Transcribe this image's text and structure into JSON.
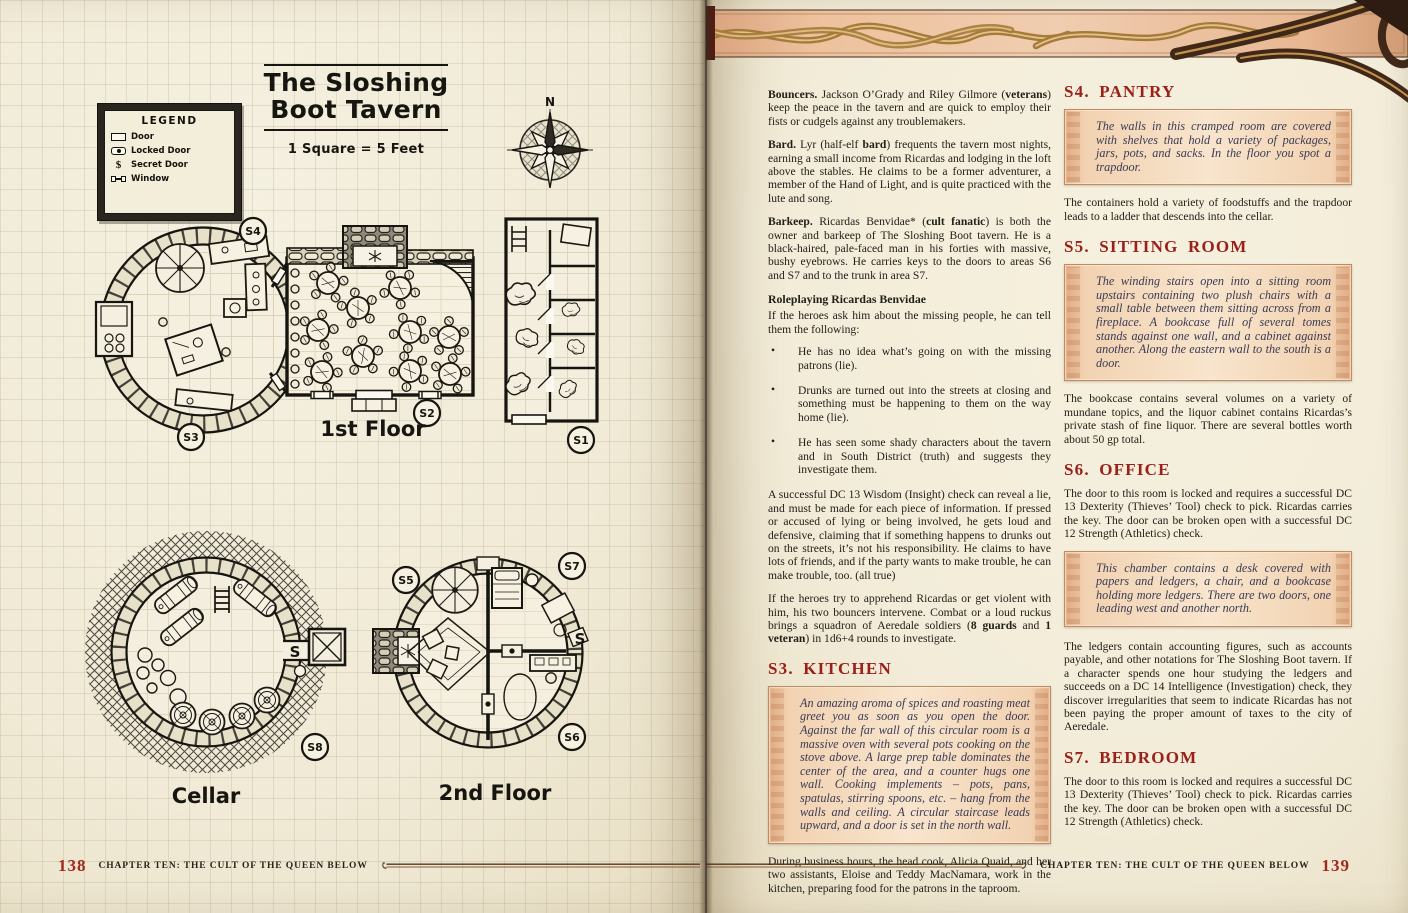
{
  "book": {
    "colors": {
      "heading_red": "#9b2019",
      "page_number_red": "#a02820",
      "parchment": "#f2ecd9",
      "readaloud_peach": "#f2d2b1",
      "band_gold": "#b18443",
      "ink": "#17150f"
    },
    "left_page": {
      "map": {
        "title": "The Sloshing Boot Tavern",
        "scale": "1 Square = 5 Feet",
        "compass_n": "N",
        "legend": {
          "title": "LEGEND",
          "door": "Door",
          "locked_door": "Locked Door",
          "secret_door": "Secret Door",
          "window": "Window",
          "secret_symbol": "$"
        },
        "captions": {
          "first_floor": "1st Floor",
          "cellar": "Cellar",
          "second_floor": "2nd Floor"
        },
        "labels": {
          "s1": "S1",
          "s2": "S2",
          "s3": "S3",
          "s4": "S4",
          "s5": "S5",
          "s6": "S6",
          "s7": "S7",
          "s8": "S8"
        },
        "secret_door_glyph": "S"
      },
      "footer": {
        "page_number": "138",
        "chapter": "CHAPTER TEN: THE CULT OF THE QUEEN BELOW"
      }
    },
    "right_page": {
      "col1": {
        "paragraphs": [
          [
            [
              "b",
              "Bouncers. "
            ],
            [
              "",
              "Jackson O’Grady and Riley Gilmore ("
            ],
            [
              "b",
              "veterans"
            ],
            [
              "",
              ") keep the peace in the tavern and are quick to employ their fists or cudgels against any troublemakers."
            ]
          ],
          [
            [
              "b",
              "Bard. "
            ],
            [
              "",
              "Lyr (half-elf "
            ],
            [
              "b",
              "bard"
            ],
            [
              "",
              ") frequents the tavern most nights, earning a small income from Ricardas and lodging in the loft above the stables. He claims to be a former adventurer, a member of the Hand of Light, and is quite practiced with the lute and song."
            ]
          ],
          [
            [
              "b",
              "Barkeep. "
            ],
            [
              "",
              "Ricardas Benvidae* ("
            ],
            [
              "b",
              "cult fanatic"
            ],
            [
              "",
              ") is both the owner and barkeep of The Sloshing Boot tavern. He is a black-haired, pale-faced man in his forties with massive, bushy eyebrows. He carries keys to the doors to areas S6 and S7 and to the trunk in area S7."
            ]
          ]
        ],
        "roleplaying": {
          "heading": "Roleplaying Ricardas Benvidae",
          "intro": "If the heroes ask him about the missing people, he can tell them the following:",
          "bullets": [
            "He has no idea what’s going on with the missing patrons (lie).",
            "Drunks are turned out into the streets at closing and something must be happening to them on the way home (lie).",
            "He has seen some shady characters about the tavern and in South District (truth) and suggests they investigate them."
          ]
        },
        "insight_paragraph": "A successful DC 13 Wisdom (Insight) check can reveal a lie, and must be made for each piece of information. If pressed or accused of lying or being involved, he gets loud and defensive, claiming that if something happens to drunks out on the streets, it’s not his responsibility. He claims to have lots of friends, and if the party wants to make trouble, he can make trouble, too. (all true)",
        "apprehend_paragraph": [
          [
            "",
            "If the heroes try to apprehend Ricardas or get violent with him, his two bouncers intervene. Combat or a loud ruckus brings a squadron of Aeredale soldiers ("
          ],
          [
            "b",
            "8 guards"
          ],
          [
            "",
            " and "
          ],
          [
            "b",
            "1 veteran"
          ],
          [
            "",
            ") in 1d6+4 rounds to investigate."
          ]
        ],
        "s3": {
          "heading": "S3. KITCHEN",
          "box": "An amazing aroma of spices and roasting meat greet you as soon as you open the door. Against the far wall of this circular room is a massive oven with several pots cooking on the stove above. A large prep table dominates the center of the area, and a counter hugs one wall. Cooking implements – pots, pans, spatulas, stirring spoons, etc. – hang from the walls and ceiling. A circular staircase leads upward, and a door is set in the north wall.",
          "after": "During business hours, the head cook, Alicia Quaid, and her two assistants, Eloise and Teddy MacNamara, work in the kitchen, preparing food for the patrons in the taproom."
        }
      },
      "col2": {
        "s4": {
          "heading": "S4. PANTRY",
          "box": "The walls in this cramped room are covered with shelves that hold a variety of packages, jars, pots, and sacks. In the floor you spot a trapdoor.",
          "after": "The containers hold a variety of foodstuffs and the trapdoor leads to a ladder that descends into the cellar."
        },
        "s5": {
          "heading": "S5. SITTING ROOM",
          "box": "The winding stairs open into a sitting room upstairs containing two plush chairs with a small table between them sitting across from a fireplace. A bookcase full of several tomes stands against one wall, and a cabinet against another. Along the eastern wall to the south is a door.",
          "after": "The bookcase contains several volumes on a variety of mundane topics, and the liquor cabinet contains Ricardas’s private stash of fine liquor. There are several bottles worth about 50 gp total."
        },
        "s6": {
          "heading": "S6. OFFICE",
          "before": "The door to this room is locked and requires a successful DC 13 Dexterity (Thieves’ Tool) check to pick. Ricardas carries the key. The door can be broken open with a successful DC 12 Strength (Athletics) check.",
          "box": "This chamber contains a desk covered with papers and ledgers, a chair, and a bookcase holding more ledgers. There are two doors, one leading west and another north.",
          "after": "The ledgers contain accounting figures, such as accounts payable, and other notations for The Sloshing Boot tavern. If a character spends one hour studying the ledgers and succeeds on a DC 14 Intelligence (Investigation) check, they discover irregularities that seem to indicate Ricardas has not been paying the proper amount of taxes to the city of Aeredale."
        },
        "s7": {
          "heading": "S7. BEDROOM",
          "text": "The door to this room is locked and requires a successful DC 13 Dexterity (Thieves’ Tool) check to pick. Ricardas carries the key. The door can be broken open with a successful DC 12 Strength (Athletics) check."
        }
      },
      "footer": {
        "page_number": "139",
        "chapter": "CHAPTER TEN: THE CULT OF THE QUEEN BELOW"
      }
    }
  }
}
